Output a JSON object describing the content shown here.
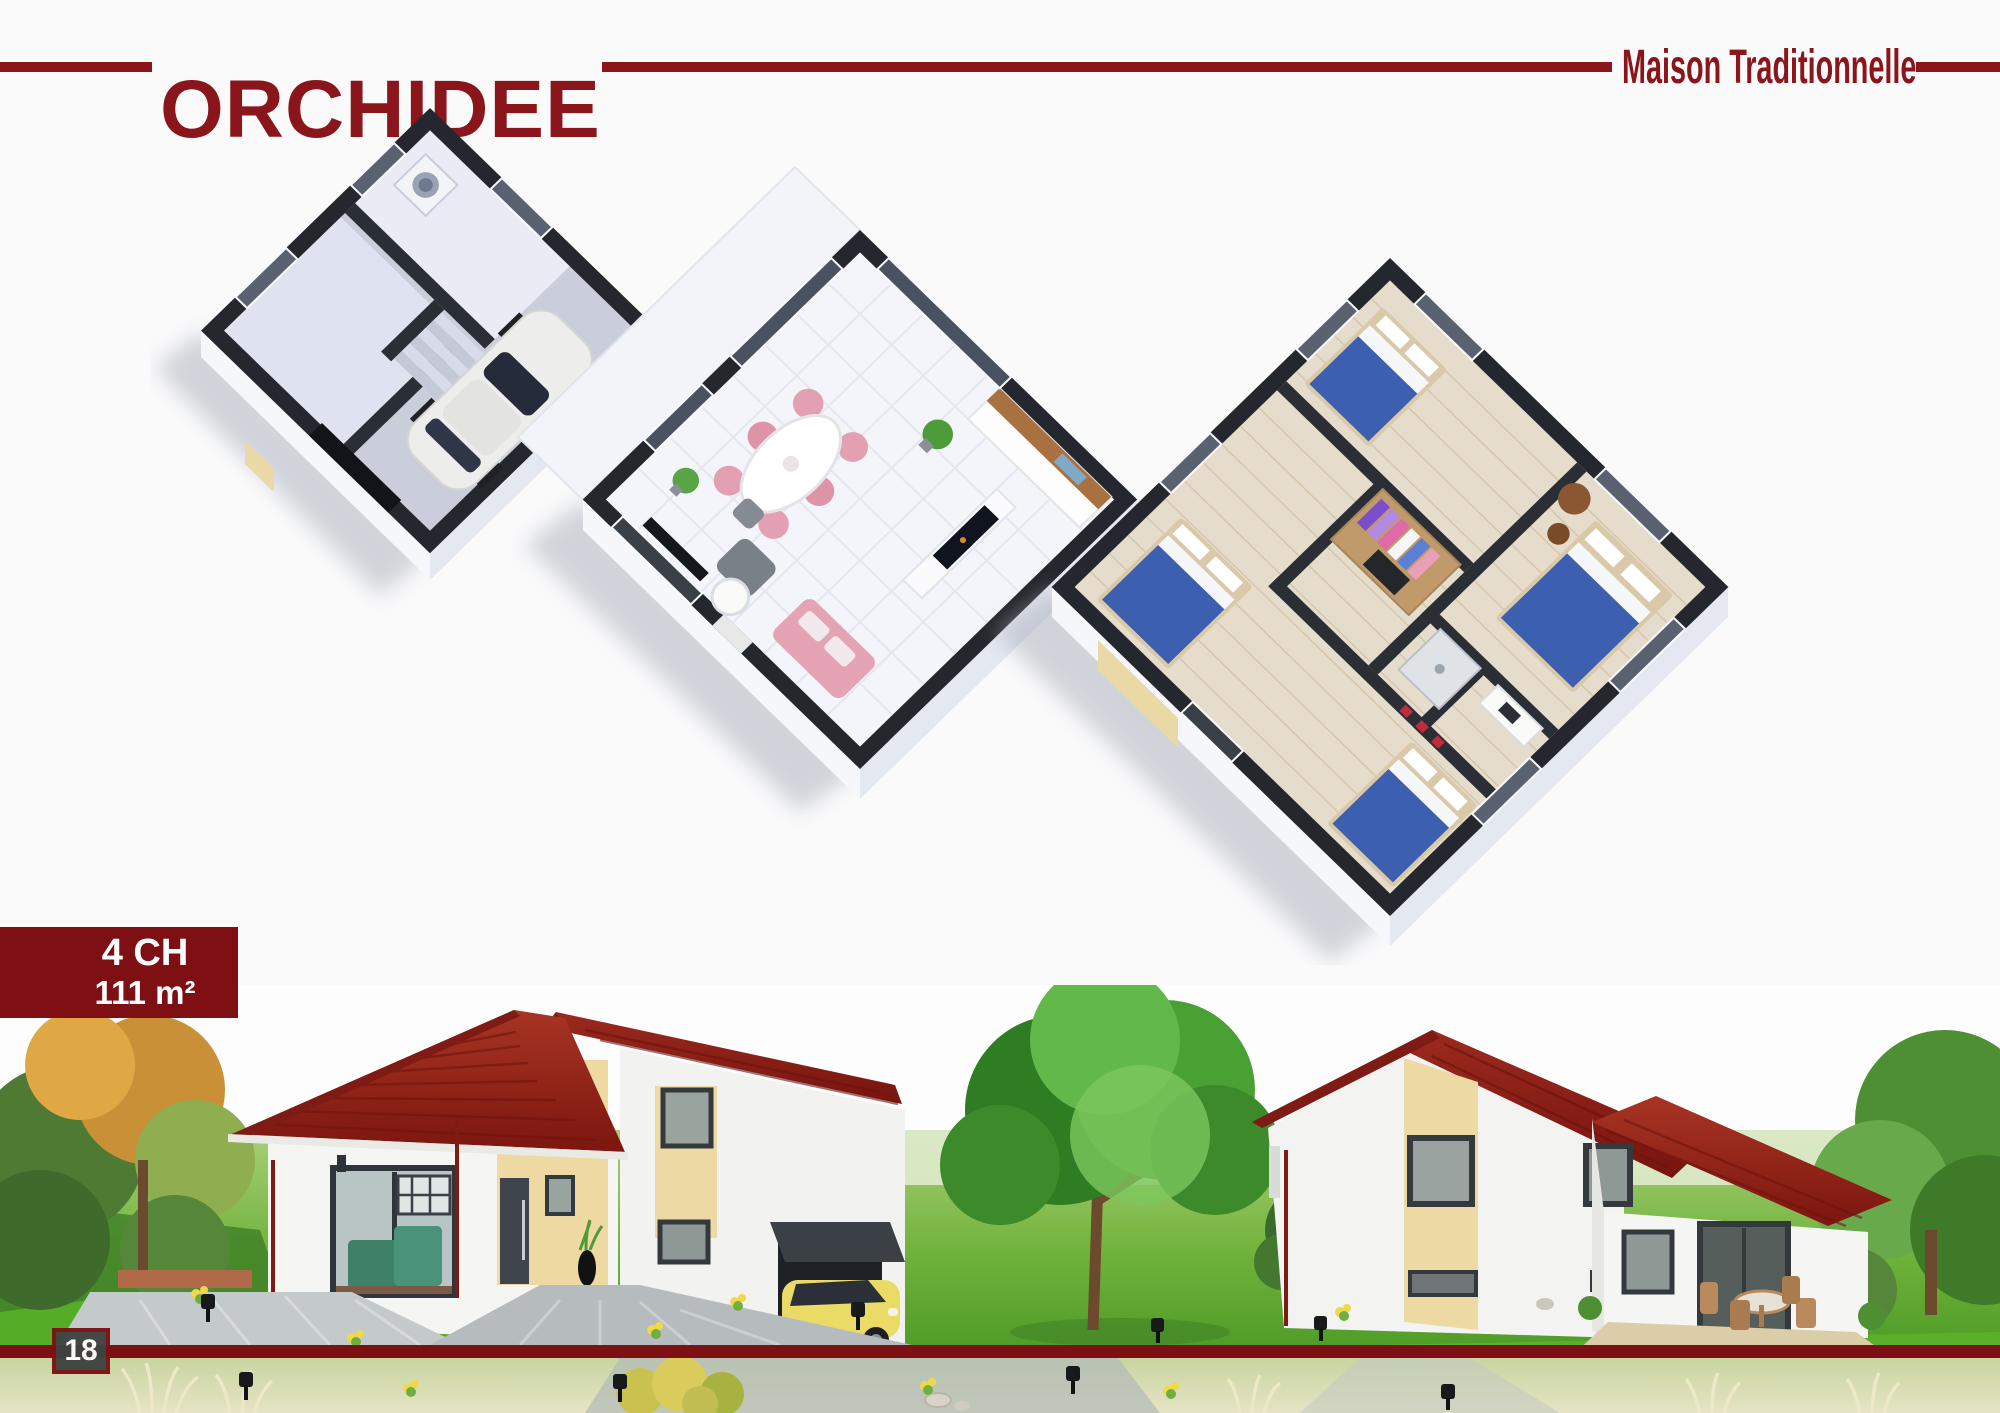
{
  "header": {
    "title": "ORCHIDEE",
    "subtitle": "Maison Traditionnelle"
  },
  "spec_badge": {
    "bedrooms_label": "4 CH",
    "area_label": "111 m²"
  },
  "footer": {
    "page_number": "18"
  },
  "palette": {
    "brand_maroon": "#8A151A",
    "rule_maroon": "#7D1013",
    "badge_background": "#7E1013",
    "badge_text": "#FFFFFF",
    "page_number_background": "#3E4340",
    "roof_red": "#93251D",
    "wall_white": "#F4F4F2",
    "accent_beige": "#EDD9A4",
    "lawn_green": "#69AE3F",
    "floorplan_wall_dark": "#24272D"
  },
  "illustrations": {
    "floor_plans": [
      {
        "name": "ground-floor-garage-plan"
      },
      {
        "name": "main-living-floor-plan"
      },
      {
        "name": "bedrooms-floor-plan"
      }
    ],
    "exterior_views": [
      {
        "name": "front-exterior-view"
      },
      {
        "name": "rear-exterior-view"
      }
    ]
  }
}
